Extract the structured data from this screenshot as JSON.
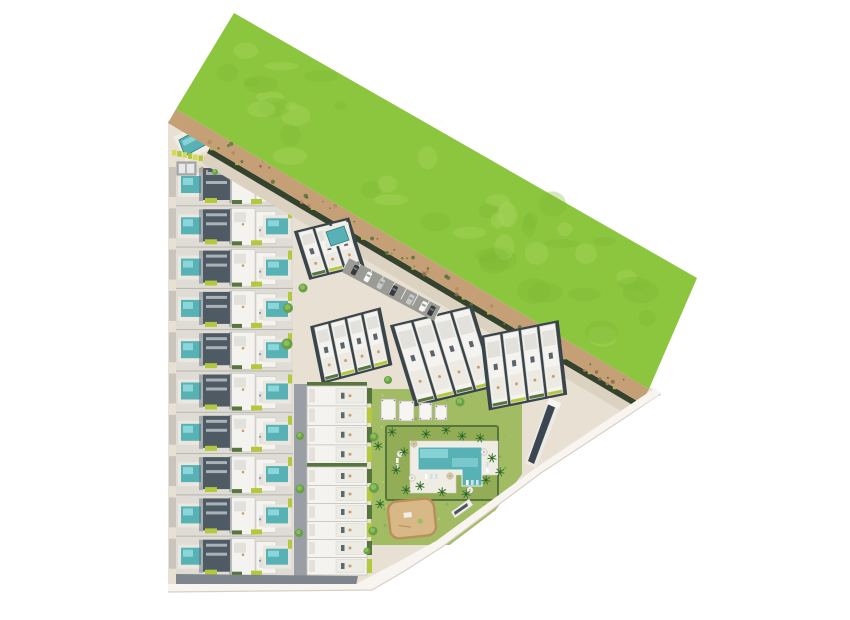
{
  "scene": {
    "kind": "aerial-site-plan-render",
    "background": "#ffffff"
  },
  "palette": {
    "grass": "#8cc63f",
    "grass_light": "#a4d45c",
    "grass_dark": "#7cb836",
    "dirt": "#c5a076",
    "dirt_dark": "#8a6b4a",
    "dirt_bush": "#5e7a3c",
    "dirt_sand": "#b0895e",
    "pavement": "#e8e1d3",
    "road": "#dcd2c1",
    "asphalt": "#9b9b96",
    "alley": "#999fa4",
    "bottom_road": "#7e858c",
    "boundary": "#f8f4ef",
    "boundary_line": "#d9cfc7",
    "roof_white": "#f4f3ef",
    "roof_light": "#e2e1dc",
    "roof_gray": "#aab2b8",
    "roof_dark": "#4e5a64",
    "frame_dark": "#39454b",
    "hedge": "#35422e",
    "hedge_green": "#57763e",
    "lime": "#b4c83e",
    "lime_bright": "#d4da52",
    "pool": "#58b1b4",
    "pool_light": "#9adfe2",
    "pool_deck": "#efece4",
    "pool_edge": "#2e7d85",
    "lawn": "#a2bc64",
    "lawn_dark": "#93ad57",
    "lawn_dot_light": "#b9cc7c",
    "lawn_dot_dark": "#87a24b",
    "tree": "#69a047",
    "tree_light": "#8fc45e",
    "palm": "#3e7a33",
    "palm_core": "#2f5e28",
    "playground_border": "#bb8f5a",
    "playground": "#d9b887",
    "shadow": "#5b6670",
    "car_dark": "#3a3a3e",
    "car_silver": "#c9c9c7",
    "car_white": "#f6f6f4",
    "furniture": "#c9a06a",
    "umbrella_tan": "#d9c9a4",
    "umbrella_white": "#eeeeea"
  },
  "site": {
    "green_field": {
      "feature": "perimeter-grass-field"
    },
    "dirt_track": {
      "feature": "perimeter-dirt-track"
    },
    "villa_terrace_block": {
      "rows": 10,
      "units_per_row": 2,
      "private_pools_per_row": 2
    },
    "tilted_clusters": [
      {
        "units": 3
      },
      {
        "units": 4
      },
      {
        "units": 4
      },
      {
        "units": 4
      }
    ],
    "apartment_strip": {
      "blocks": [
        {
          "units": 4
        },
        {
          "units": 6
        }
      ]
    },
    "parking_lot": {
      "cars": 7,
      "stalls": 8
    },
    "amenity_garden": {
      "communal_pool": 1,
      "pergolas": 4,
      "palm_trees": 16,
      "umbrellas": 6,
      "sun_loungers": 10,
      "playground": 1
    },
    "entrance_amenity": {
      "lap_pool": 1,
      "loungers": 7
    },
    "edge_buildings": 2
  }
}
